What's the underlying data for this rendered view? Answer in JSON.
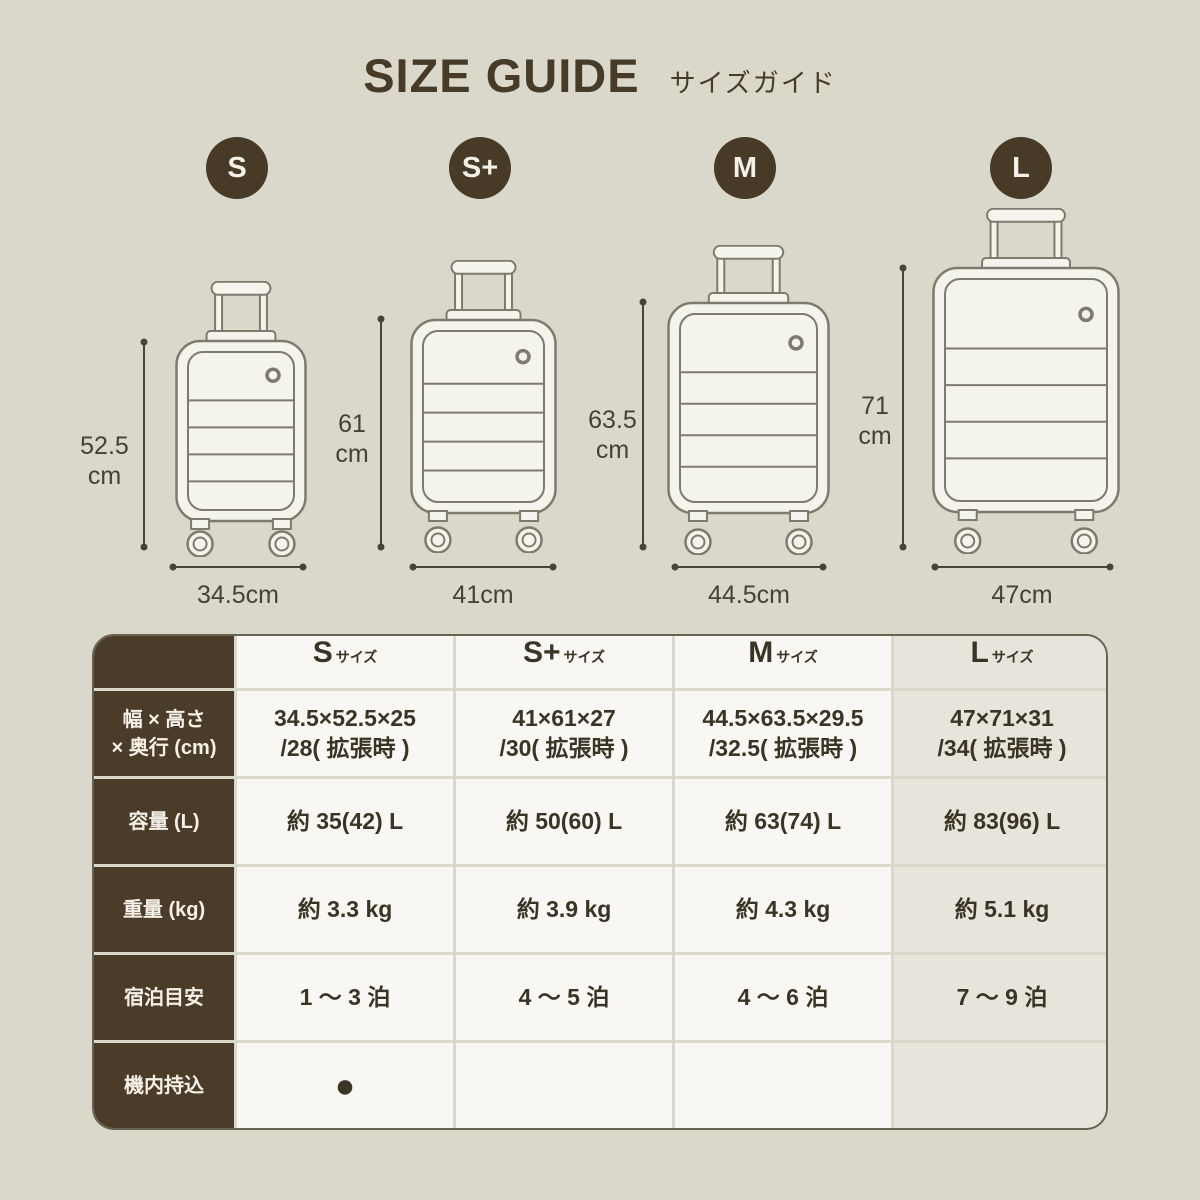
{
  "title": {
    "en": "SIZE GUIDE",
    "ja": "サイズガイド"
  },
  "colors": {
    "background": "#d9d8cb",
    "accent": "#473a26",
    "table_cell": "#f8f7f3",
    "table_cell_highlight": "#e6e4db",
    "table_label_bg": "#4b3c29",
    "illustration_line": "#7e7b6c",
    "dimension_text": "#42423a"
  },
  "sizes": [
    {
      "badge": "S",
      "height_value": "52.5",
      "height_unit": "cm",
      "width_label": "34.5cm"
    },
    {
      "badge": "S+",
      "height_value": "61",
      "height_unit": "cm",
      "width_label": "41cm"
    },
    {
      "badge": "M",
      "height_value": "63.5",
      "height_unit": "cm",
      "width_label": "44.5cm"
    },
    {
      "badge": "L",
      "height_value": "71",
      "height_unit": "cm",
      "width_label": "47cm"
    }
  ],
  "table": {
    "headers": [
      {
        "main": "S",
        "sub": "サイズ"
      },
      {
        "main": "S+",
        "sub": "サイズ"
      },
      {
        "main": "M",
        "sub": "サイズ"
      },
      {
        "main": "L",
        "sub": "サイズ"
      }
    ],
    "rows": [
      {
        "label_lines": [
          "幅 × 高さ",
          "× 奥行 (cm)"
        ],
        "cells": [
          [
            "34.5×52.5×25",
            "/28( 拡張時 )"
          ],
          [
            "41×61×27",
            "/30( 拡張時 )"
          ],
          [
            "44.5×63.5×29.5",
            "/32.5( 拡張時 )"
          ],
          [
            "47×71×31",
            "/34( 拡張時 )"
          ]
        ]
      },
      {
        "label_lines": [
          "容量 (L)"
        ],
        "cells": [
          [
            "約 35(42) L"
          ],
          [
            "約 50(60) L"
          ],
          [
            "約 63(74) L"
          ],
          [
            "約 83(96) L"
          ]
        ]
      },
      {
        "label_lines": [
          "重量 (kg)"
        ],
        "cells": [
          [
            "約 3.3 kg"
          ],
          [
            "約 3.9 kg"
          ],
          [
            "約 4.3 kg"
          ],
          [
            "約 5.1 kg"
          ]
        ]
      },
      {
        "label_lines": [
          "宿泊目安"
        ],
        "cells": [
          [
            "1 〜 3 泊"
          ],
          [
            "4 〜 5 泊"
          ],
          [
            "4 〜 6 泊"
          ],
          [
            "7 〜 9 泊"
          ]
        ]
      },
      {
        "label_lines": [
          "機内持込"
        ],
        "cells": [
          [
            "●"
          ],
          [
            ""
          ],
          [
            ""
          ],
          [
            ""
          ]
        ]
      }
    ]
  }
}
